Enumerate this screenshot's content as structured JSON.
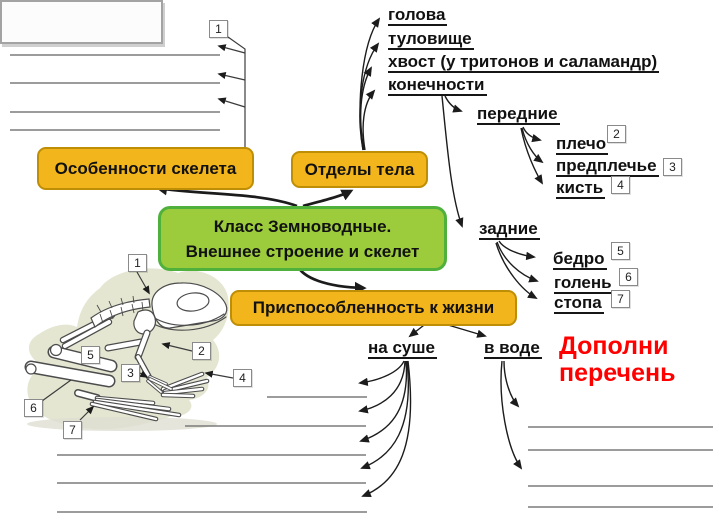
{
  "colors": {
    "orange_fill": "#F2B51C",
    "orange_border": "#BE8E06",
    "green_fill": "#9CCB3C",
    "green_border": "#4FB13C",
    "note_red": "#FE0000"
  },
  "top_callout": {
    "num": "1"
  },
  "boxes": {
    "skeleton_features": "Особенности скелета",
    "body_parts": "Отделы тела",
    "center_line1": "Класс Земноводные.",
    "center_line2": "Внешнее строение и скелет",
    "adaptation": "Приспособленность к жизни"
  },
  "body_parts_items": [
    "голова",
    "туловище",
    "хвост (у тритонов и саламандр)",
    "конечности"
  ],
  "front_limbs": {
    "label": "передние",
    "items": [
      {
        "name": "плечо",
        "num": "2"
      },
      {
        "name": "предплечье",
        "num": "3"
      },
      {
        "name": "кисть",
        "num": "4"
      }
    ]
  },
  "hind_limbs": {
    "label": "задние",
    "items": [
      {
        "name": "бедро",
        "num": "5"
      },
      {
        "name": "голень",
        "num": "6"
      },
      {
        "name": "стопа",
        "num": "7"
      }
    ]
  },
  "adaptation_items": {
    "land": "на суше",
    "water": "в воде"
  },
  "note": {
    "line1": "Дополни",
    "line2": "перечень"
  },
  "frog_callouts": [
    "1",
    "2",
    "3",
    "4",
    "5",
    "6",
    "7"
  ]
}
